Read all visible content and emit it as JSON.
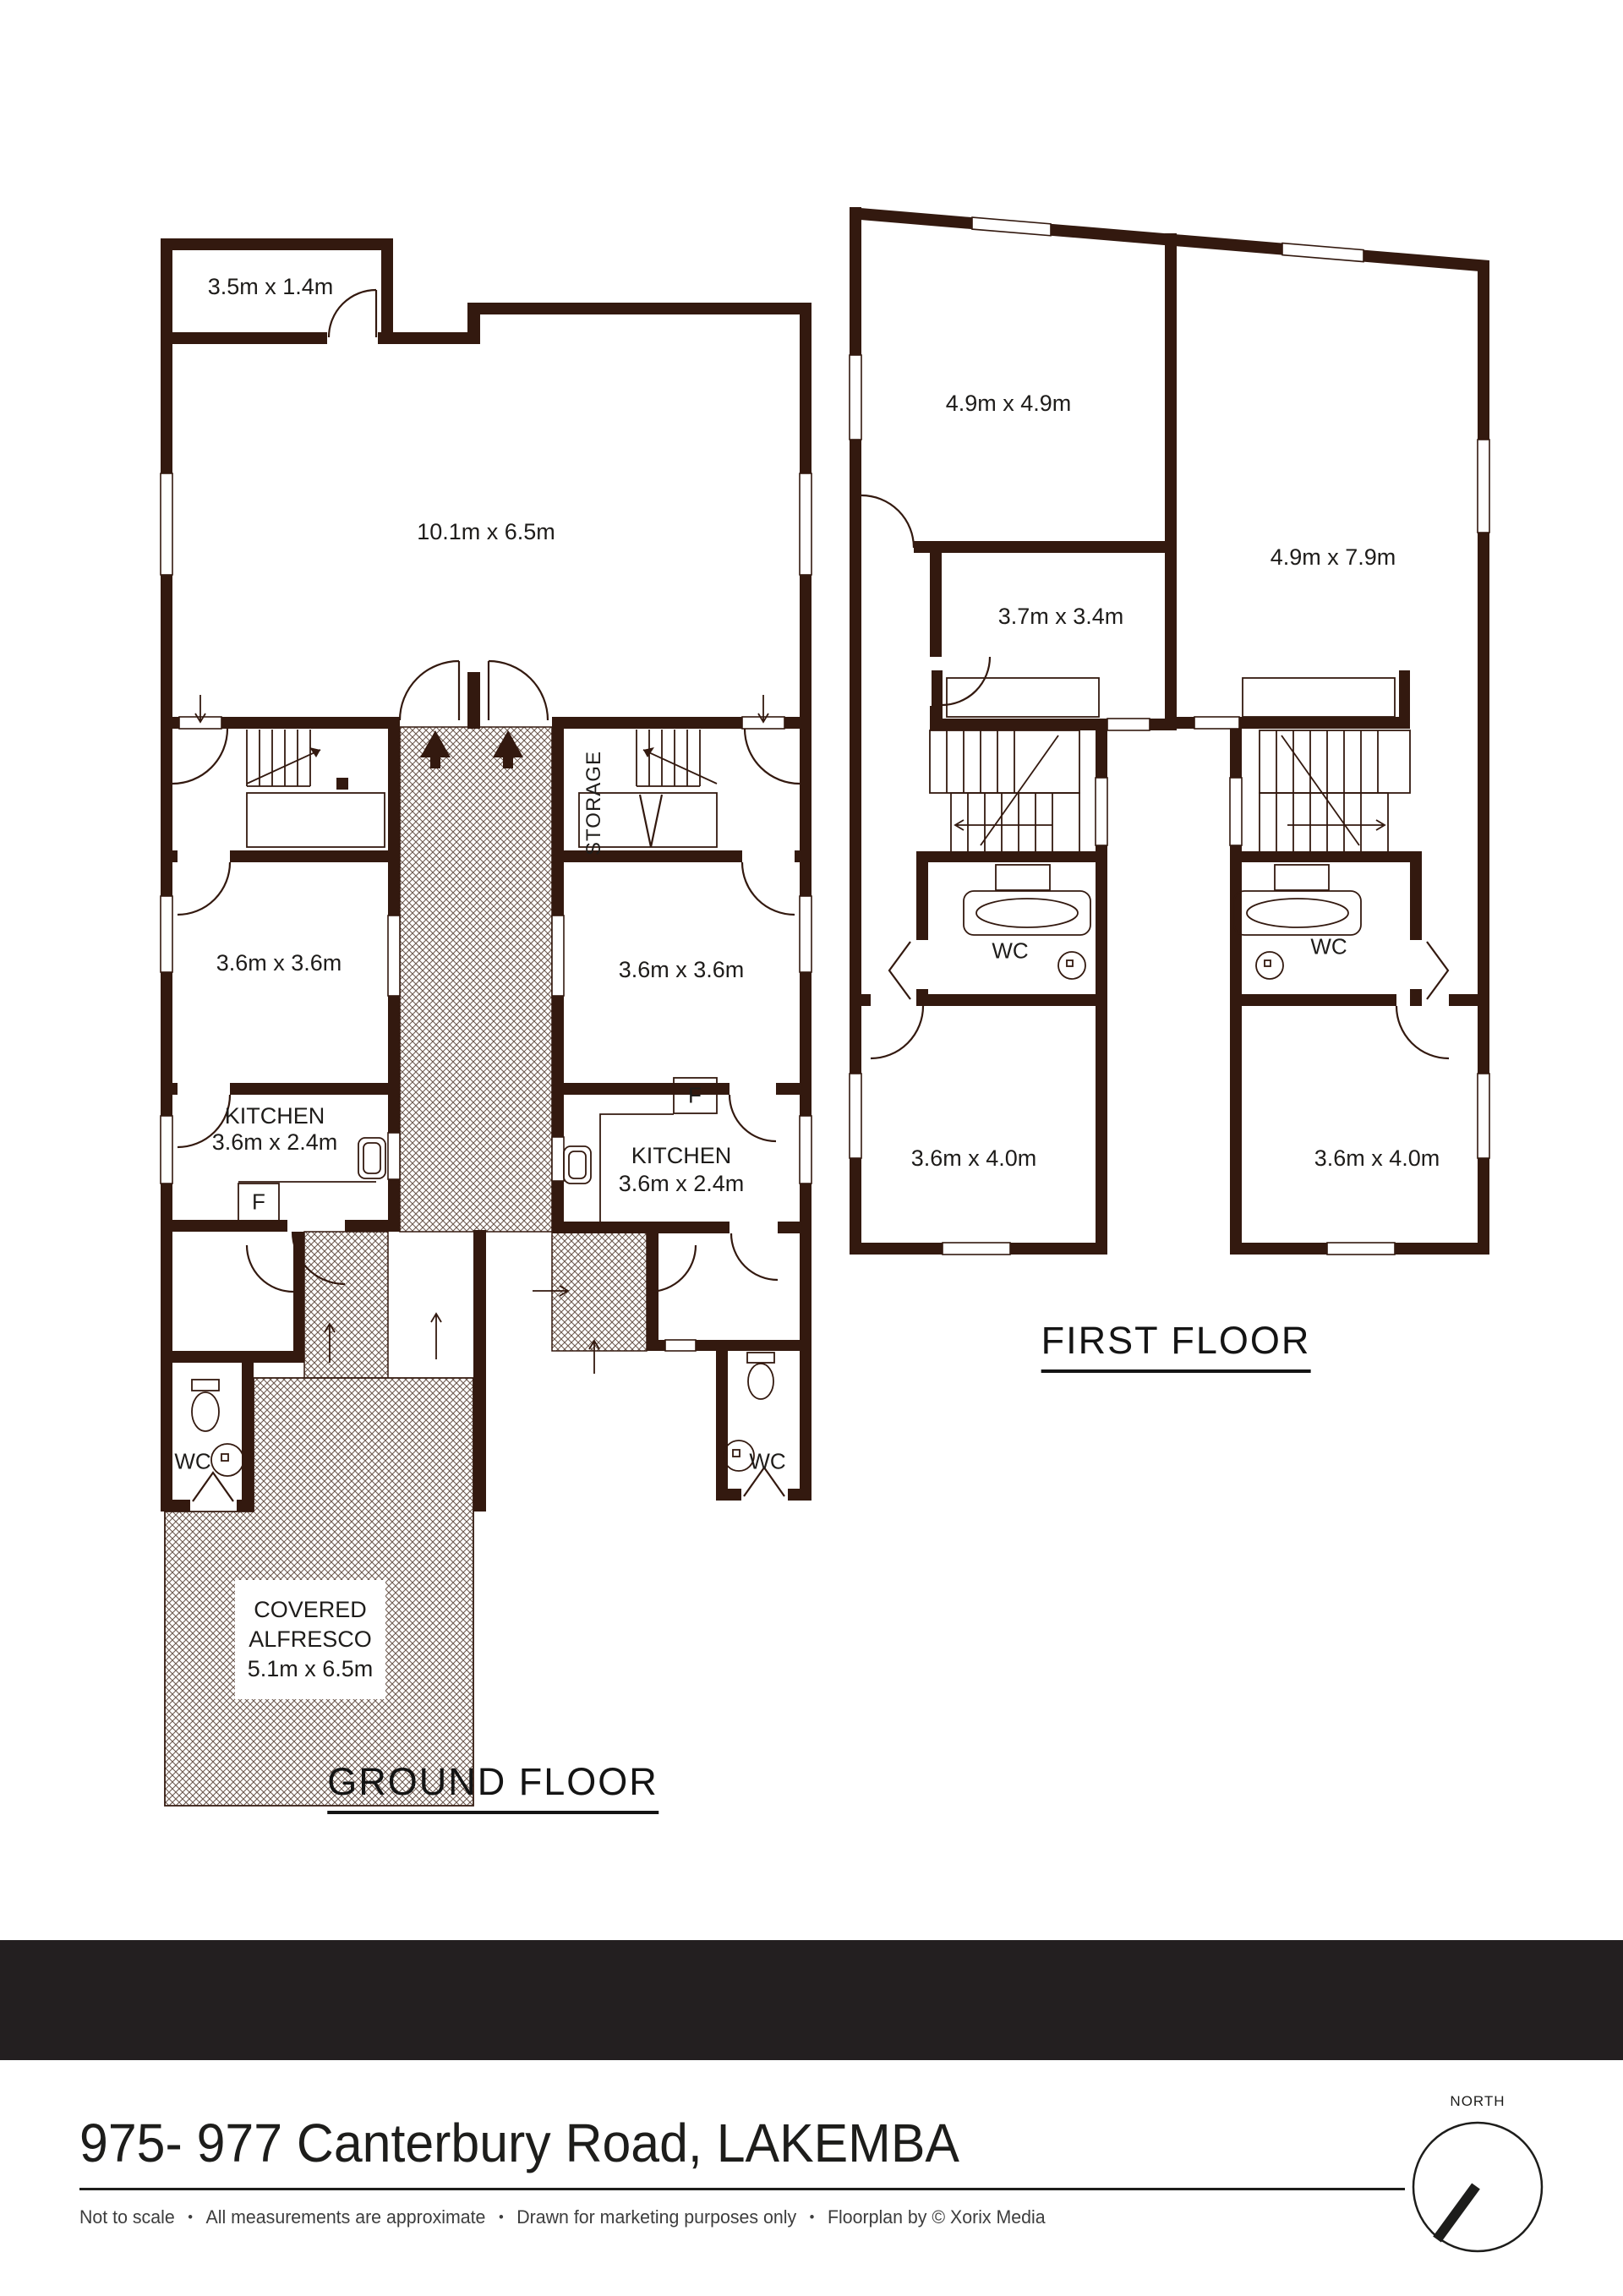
{
  "colors": {
    "wall": "#33190f",
    "hatch_line": "#6e5a50",
    "text": "#1e1c1a",
    "footer_bar": "#231f20",
    "disclaimer_text": "#3d3d3d"
  },
  "ground_floor": {
    "title": "GROUND FLOOR",
    "rooms": {
      "porch": "3.5m x 1.4m",
      "living": "10.1m x 6.5m",
      "storage": "STORAGE",
      "bedroom_left": "3.6m x 3.6m",
      "bedroom_right": "3.6m x 3.6m",
      "kitchen_left_name": "KITCHEN",
      "kitchen_left_dims": "3.6m x 2.4m",
      "kitchen_right_name": "KITCHEN",
      "kitchen_right_dims": "3.6m x 2.4m",
      "fridge_left": "F",
      "fridge_right": "F",
      "wc_left": "WC",
      "wc_right": "WC",
      "alfresco_line1": "COVERED",
      "alfresco_line2": "ALFRESCO",
      "alfresco_dims": "5.1m x 6.5m"
    }
  },
  "first_floor": {
    "title": "FIRST FLOOR",
    "rooms": {
      "bedroom_top_left": "4.9m x 4.9m",
      "living_right": "4.9m x 7.9m",
      "bedroom_mid_left": "3.7m x 3.4m",
      "wc_left": "WC",
      "wc_right": "WC",
      "bedroom_bottom_left": "3.6m x 4.0m",
      "bedroom_bottom_right": "3.6m x 4.0m"
    }
  },
  "footer": {
    "address": "975- 977 Canterbury Road, LAKEMBA",
    "bullet": "•",
    "disclaimer": [
      "Not to scale",
      "All measurements are approximate",
      "Drawn for marketing purposes only",
      "Floorplan by © Xorix Media"
    ],
    "north_label": "NORTH"
  }
}
